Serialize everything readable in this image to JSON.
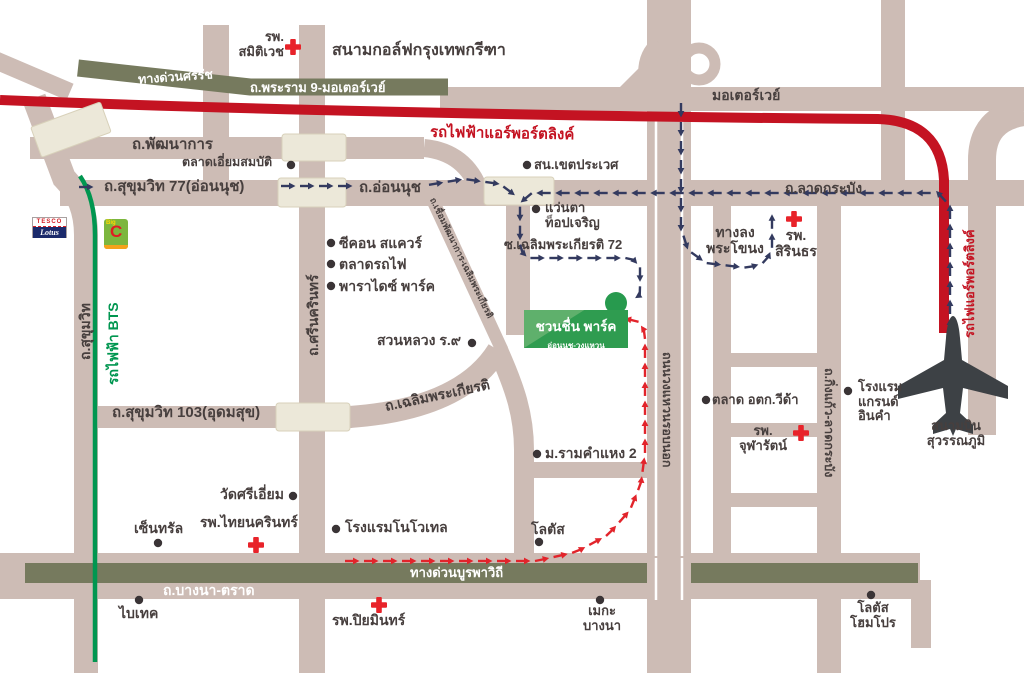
{
  "colors": {
    "road": "#cdbcb5",
    "cream": "#ece8d9",
    "expressway": "#767a5e",
    "rail_red": "#c41322",
    "bts_green": "#009650",
    "route_navy": "#333a5f",
    "route_red": "#e2242b",
    "ink": "#473f3e",
    "park_green": "#2f9c50",
    "plane_gray": "#3d4145",
    "dot_black": "#3a3436",
    "cross_red": "#e8232a"
  },
  "transit": {
    "airport_link_top": "รถไฟฟ้าแอร์พอร์ตลิงค์",
    "airport_link_side": "รถไฟแอร์พอร์ตลิงค์",
    "bts": "รถไฟฟ้า BTS"
  },
  "expressways": {
    "srirat": "ทางด่วนศรีรัช",
    "rama9_motorway": "ถ.พระราม 9-มอเตอร์เวย์",
    "motorway": "มอเตอร์เวย์",
    "burapha": "ทางด่วนบูรพาวิถี",
    "bangna_trat": "ถ.บางนา-ตราด"
  },
  "roads": {
    "phatthanakan": "ถ.พัฒนาการ",
    "sukhumvit77": "ถ.สุขุมวิท 77(อ่อนนุช)",
    "onnut": "ถ.อ่อนนุช",
    "lat_krabang": "ถ.ลาดกระบัง",
    "sukhumvit": "ถ.สุขุมวิท",
    "srinagarindra": "ถ.ศรีนครินทร์",
    "soi_chaloem72": "ซ.เฉลิมพระเกียรติ 72",
    "chaloem_phrakiat": "ถ.เฉลิมพระเกียรติ",
    "chueam_phatthanakan": "ถ.เชื่อมพัฒนาการ-เฉลิมพระเกียรติ",
    "sukhumvit103": "ถ.สุขุมวิท 103(อุดมสุข)",
    "outer_ring": "ถนนวงแหวนรอบนอก",
    "king_kaeo": "ถ.กิ่งแก้ว-ลาดกระบัง",
    "phrakanong_exit_line1": "ทางลง",
    "phrakanong_exit_line2": "พระโขนง"
  },
  "hospitals": {
    "samitivej_line1": "รพ.",
    "samitivej_line2": "สมิติเวช",
    "sirindhorn_line1": "รพ.",
    "sirindhorn_line2": "สิรินธร",
    "chularat_line1": "รพ.",
    "chularat_line2": "จุฬารัตน์",
    "thai_nakarin": "รพ.ไทยนครินทร์",
    "piyamin": "รพ.ปิยมินทร์"
  },
  "places": {
    "golf": "สนามกอล์ฟกรุงเทพกรีฑา",
    "iam_sombat": "ตลาดเอี่ยมสมบัติ",
    "prawet_police": "สน.เขตประเวศ",
    "top_charoen_line1": "แว่นตา",
    "top_charoen_line2": "ท็อปเจริญ",
    "seacon": "ซีคอน สแควร์",
    "train_market": "ตลาดรถไฟ",
    "paradise": "พาราไดซ์ พาร์ค",
    "suan_luang": "สวนหลวง ร.๙",
    "ramkhamhaeng2": "ม.รามคำแหง 2",
    "lotus": "โลตัส",
    "novotel": "โรงแรมโนโวเทล",
    "central": "เซ็นทรัล",
    "wat_sri_iam": "วัดศรีเอี่ยม",
    "bitec": "ไบเทค",
    "mega_line1": "เมกะ",
    "mega_line2": "บางนา",
    "otk_market": "ตลาด อตก.วีด้า",
    "grand_inkham_line1": "โรงแรม",
    "grand_inkham_line2": "แกรนด์",
    "grand_inkham_line3": "อินคำ",
    "lotus_homepro_line1": "โลตัส",
    "lotus_homepro_line2": "โฮมโปร",
    "airport_line1": "สนามบิน",
    "airport_line2": "สุวรรณภูมิ"
  },
  "destination": {
    "title": "ชวนชื่น พาร์ค",
    "subtitle": "อ่อนนุช-วงแหวน"
  },
  "logos": {
    "tesco_line1": "TESCO",
    "tesco_line2": "Lotus",
    "bigc_big": "Big",
    "bigc_c": "C"
  }
}
